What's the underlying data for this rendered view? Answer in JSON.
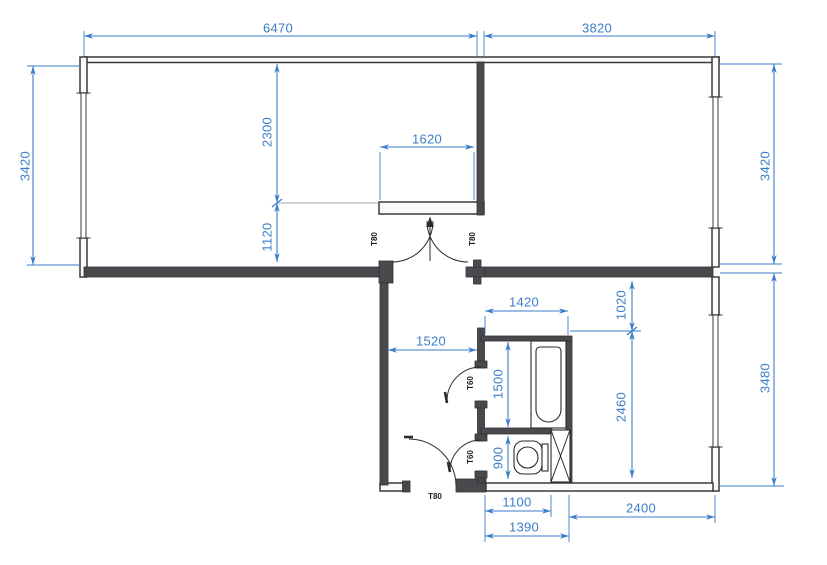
{
  "drawing": {
    "kind": "apartment-floor-plan",
    "colors": {
      "dimension": "#3b7dc9",
      "wall_solid": "#4a4a4e",
      "wall_outline": "#3a3a3c",
      "line": "#2b2b2b",
      "background": "#ffffff"
    },
    "dimensions": {
      "top_left_width": "6470",
      "top_right_width": "3820",
      "left_height": "3420",
      "living_upper": "2300",
      "living_lower": "1120",
      "alcove_width": "1620",
      "right_upper_height": "3420",
      "right_lower_height": "3480",
      "kitchen_upper": "1020",
      "kitchen_lower": "2460",
      "hallway_width": "1520",
      "bathroom_width": "1420",
      "bathroom_depth": "1500",
      "wc_depth": "900",
      "wc_width": "1100",
      "bath_block_width": "1390",
      "kitchen_width": "2400"
    },
    "door_labels": {
      "double_left": "T80",
      "double_right": "T80",
      "bathroom": "T60",
      "wc": "T60",
      "entrance": "T80"
    }
  }
}
